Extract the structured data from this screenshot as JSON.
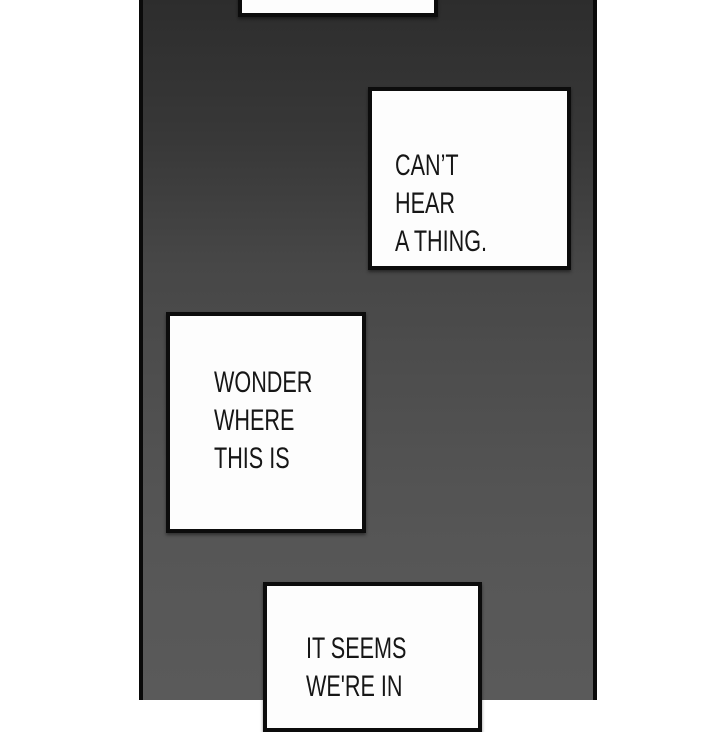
{
  "panel": {
    "type": "webtoon-comic-panel",
    "colors": {
      "page_background": "#ffffff",
      "strip_gradient_top": "#2d2d2d",
      "strip_gradient_bottom": "#5a5a5a",
      "strip_edge_rule": "#0a0a0a",
      "bubble_fill": "#fdfdfd",
      "bubble_border": "#0c0c0c",
      "text_color": "#161616"
    }
  },
  "bubbles": [
    {
      "id": "top-partial",
      "text": ""
    },
    {
      "id": "cant-hear",
      "text": "CAN’T HEAR\nA THING."
    },
    {
      "id": "wonder",
      "text": "WONDER\nWHERE\nTHIS IS"
    },
    {
      "id": "it-seems",
      "text": "IT SEEMS\nWE'RE IN"
    }
  ]
}
